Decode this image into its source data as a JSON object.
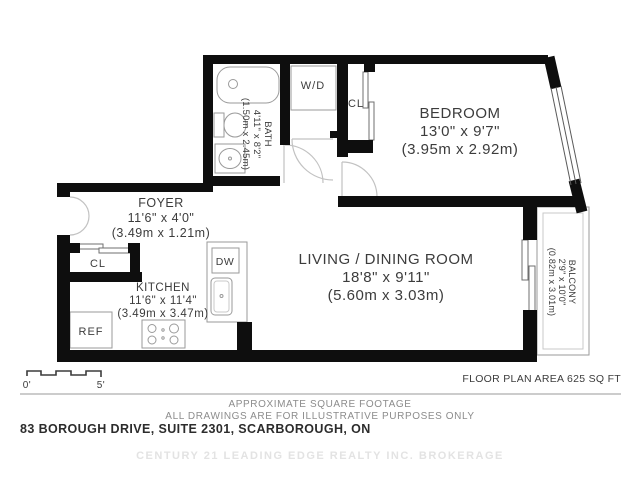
{
  "plan": {
    "rooms": {
      "bedroom": {
        "name": "BEDROOM",
        "dim_ft": "13'0\" x 9'7\"",
        "dim_m": "(3.95m x 2.92m)"
      },
      "living": {
        "name": "LIVING / DINING ROOM",
        "dim_ft": "18'8\" x 9'11\"",
        "dim_m": "(5.60m x 3.03m)"
      },
      "foyer": {
        "name": "FOYER",
        "dim_ft": "11'6\" x 4'0\"",
        "dim_m": "(3.49m x 1.21m)"
      },
      "kitchen": {
        "name": "KITCHEN",
        "dim_ft": "11'6\" x 11'4\"",
        "dim_m": "(3.49m x 3.47m)"
      },
      "bath": {
        "name": "BATH",
        "dim_ft": "4'11\" x 8'2\"",
        "dim_m": "(1.50m x 2.45m)"
      },
      "balcony": {
        "name": "BALCONY",
        "dim_ft": "2'9\" x 10'0\"",
        "dim_m": "(0.82m x 3.01m)"
      }
    },
    "labels": {
      "wd": "W/D",
      "cl_bedroom": "CL",
      "cl_foyer": "CL",
      "dw": "DW",
      "ref": "REF"
    },
    "scale": {
      "start": "0'",
      "end": "5'"
    },
    "area_note": "FLOOR PLAN AREA 625 SQ FT"
  },
  "footer": {
    "disclaimer1": "APPROXIMATE SQUARE FOOTAGE",
    "disclaimer2": "ALL DRAWINGS ARE FOR ILLUSTRATIVE PURPOSES ONLY",
    "address": "83 BOROUGH DRIVE, SUITE 2301, SCARBOROUGH, ON",
    "watermark": "CENTURY 21 LEADING EDGE REALTY INC. BROKERAGE"
  },
  "colors": {
    "wall": "#0e0e0e",
    "label": "#3c3c3c",
    "muted": "#8c8c8c",
    "fixture": "#9a9a9a",
    "door": "#c2c2c2",
    "watermark": "#e3e3e3"
  }
}
